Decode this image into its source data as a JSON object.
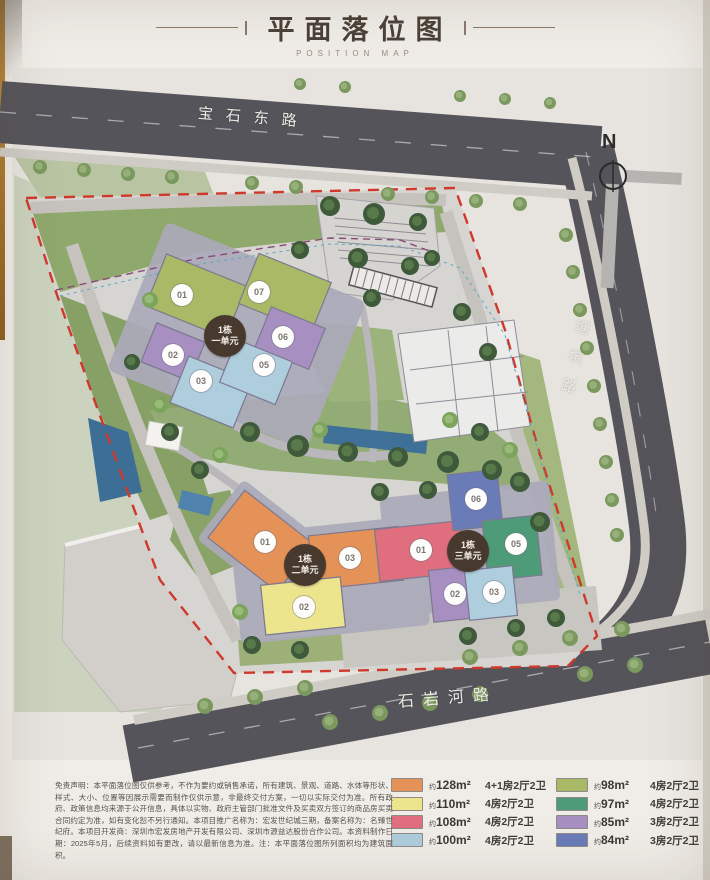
{
  "header": {
    "title": "平面落位图",
    "subtitle": "POSITION MAP"
  },
  "map": {
    "north_label": "N",
    "roads": {
      "top": "宝石东路",
      "right": "塘坑路",
      "bottom": "石岩河路"
    },
    "clusters": [
      {
        "line1": "1栋",
        "line2": "一单元",
        "units": [
          {
            "label": "01"
          },
          {
            "label": "07"
          },
          {
            "label": "02"
          },
          {
            "label": "03"
          },
          {
            "label": "05"
          },
          {
            "label": "06"
          }
        ]
      },
      {
        "line1": "1栋",
        "line2": "二单元",
        "units": [
          {
            "label": "01"
          },
          {
            "label": "03"
          },
          {
            "label": "02"
          }
        ]
      },
      {
        "line1": "1栋",
        "line2": "三单元",
        "units": [
          {
            "label": "01"
          },
          {
            "label": "06"
          },
          {
            "label": "05"
          },
          {
            "label": "02"
          },
          {
            "label": "03"
          }
        ]
      }
    ]
  },
  "legend": {
    "items": [
      {
        "color": "#E49258",
        "prefix": "约",
        "area": "128m²",
        "layout": "4+1房2厅2卫"
      },
      {
        "color": "#EDE48E",
        "prefix": "约",
        "area": "110m²",
        "layout": "4房2厅2卫"
      },
      {
        "color": "#DF6F7E",
        "prefix": "约",
        "area": "108m²",
        "layout": "4房2厅2卫"
      },
      {
        "color": "#AECDDD",
        "prefix": "约",
        "area": "100m²",
        "layout": "4房2厅2卫"
      },
      {
        "color": "#A9BA67",
        "prefix": "约",
        "area": "98m²",
        "layout": "4房2厅2卫"
      },
      {
        "color": "#4E9B78",
        "prefix": "约",
        "area": "97m²",
        "layout": "4房2厅2卫"
      },
      {
        "color": "#A78FC1",
        "prefix": "约",
        "area": "85m²",
        "layout": "3房2厅2卫"
      },
      {
        "color": "#6A7CB8",
        "prefix": "约",
        "area": "84m²",
        "layout": "3房2厅2卫"
      }
    ]
  },
  "disclaimer": "免责声明：本平面落位图仅供参考，不作为要约或销售承诺，所有建筑、景观、道路、水体等形状、样式、大小、位置等因展示需要而制作仅供示意，非最终交付方案，一切以实际交付为准。所有政府、政策信息均来源于公开信息，具体以实物、政府主管部门批准文件及买卖双方签订的商品房买卖合同约定为准，如有变化恕不另行通知。本项目推广名称为：宏发世纪城三期，备案名称为：名臻世纪府。本项目开发商：深圳市宏发房地产开发有限公司、深圳市源益达股份合作公司。本资料制作日期：2025年5月，后续资料如有更改，请以最新信息为准。注：本平面落位图所列面积均为建筑面积。"
}
